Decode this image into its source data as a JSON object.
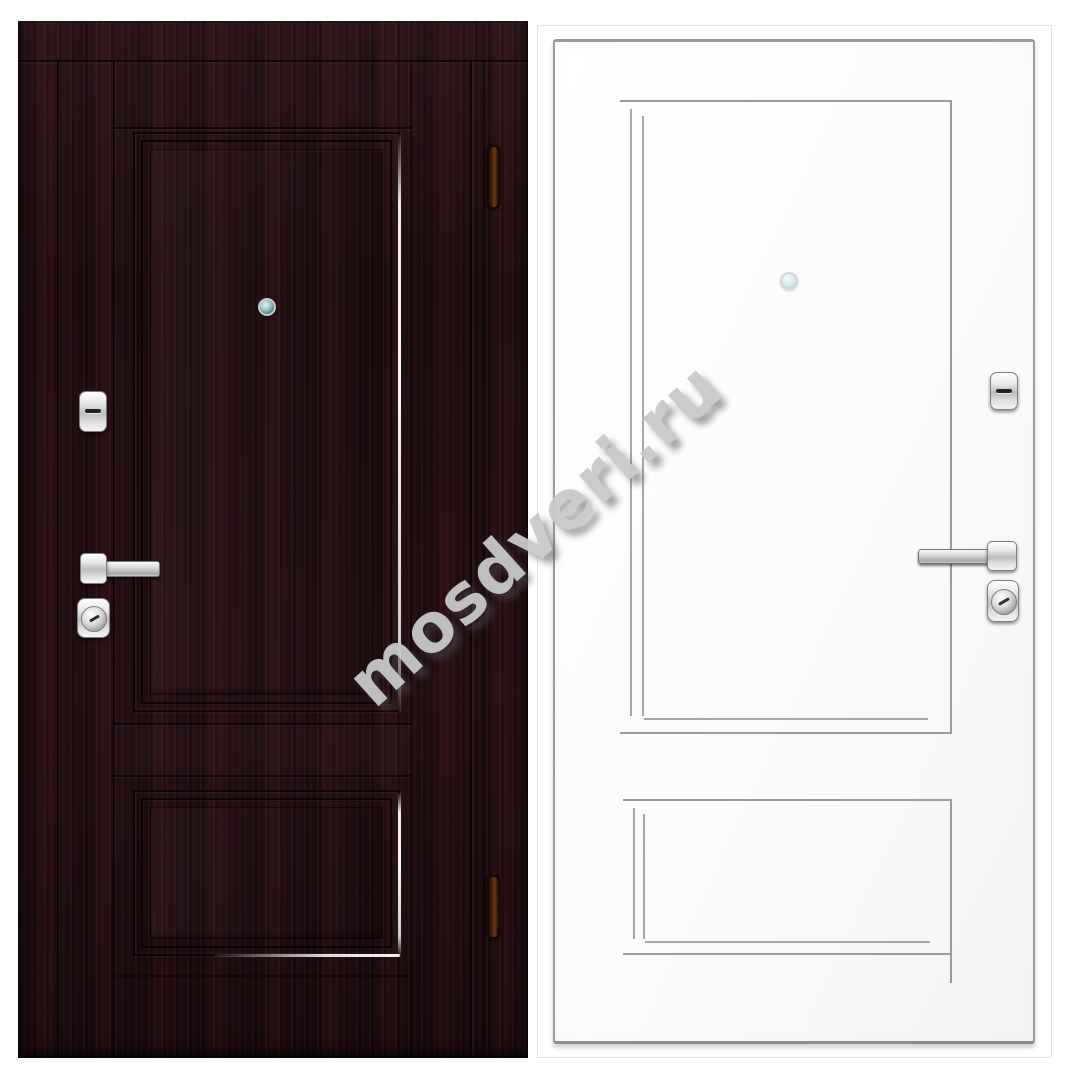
{
  "watermark": {
    "text": "mosdveri.ru"
  },
  "colors": {
    "background": "#ffffff",
    "wenge-base": "#221014",
    "wenge-line": "#0a0406",
    "silver-accent": "#eeeeee",
    "outline-grey": "#9b9b9b",
    "chrome-light": "#f4f4f4",
    "chrome-mid": "#bdbdbd",
    "hinge-amber": "#56290d",
    "watermark-grey": "#c9c9c9"
  },
  "doors": {
    "left": {
      "finish": "dark-wenge",
      "hardware": [
        "peephole",
        "deadbolt",
        "lever-handle",
        "cylinder-lock",
        "hinge-top",
        "hinge-bottom"
      ]
    },
    "right": {
      "finish": "white",
      "hardware": [
        "peephole",
        "deadbolt",
        "lever-handle",
        "cylinder-lock"
      ]
    }
  }
}
